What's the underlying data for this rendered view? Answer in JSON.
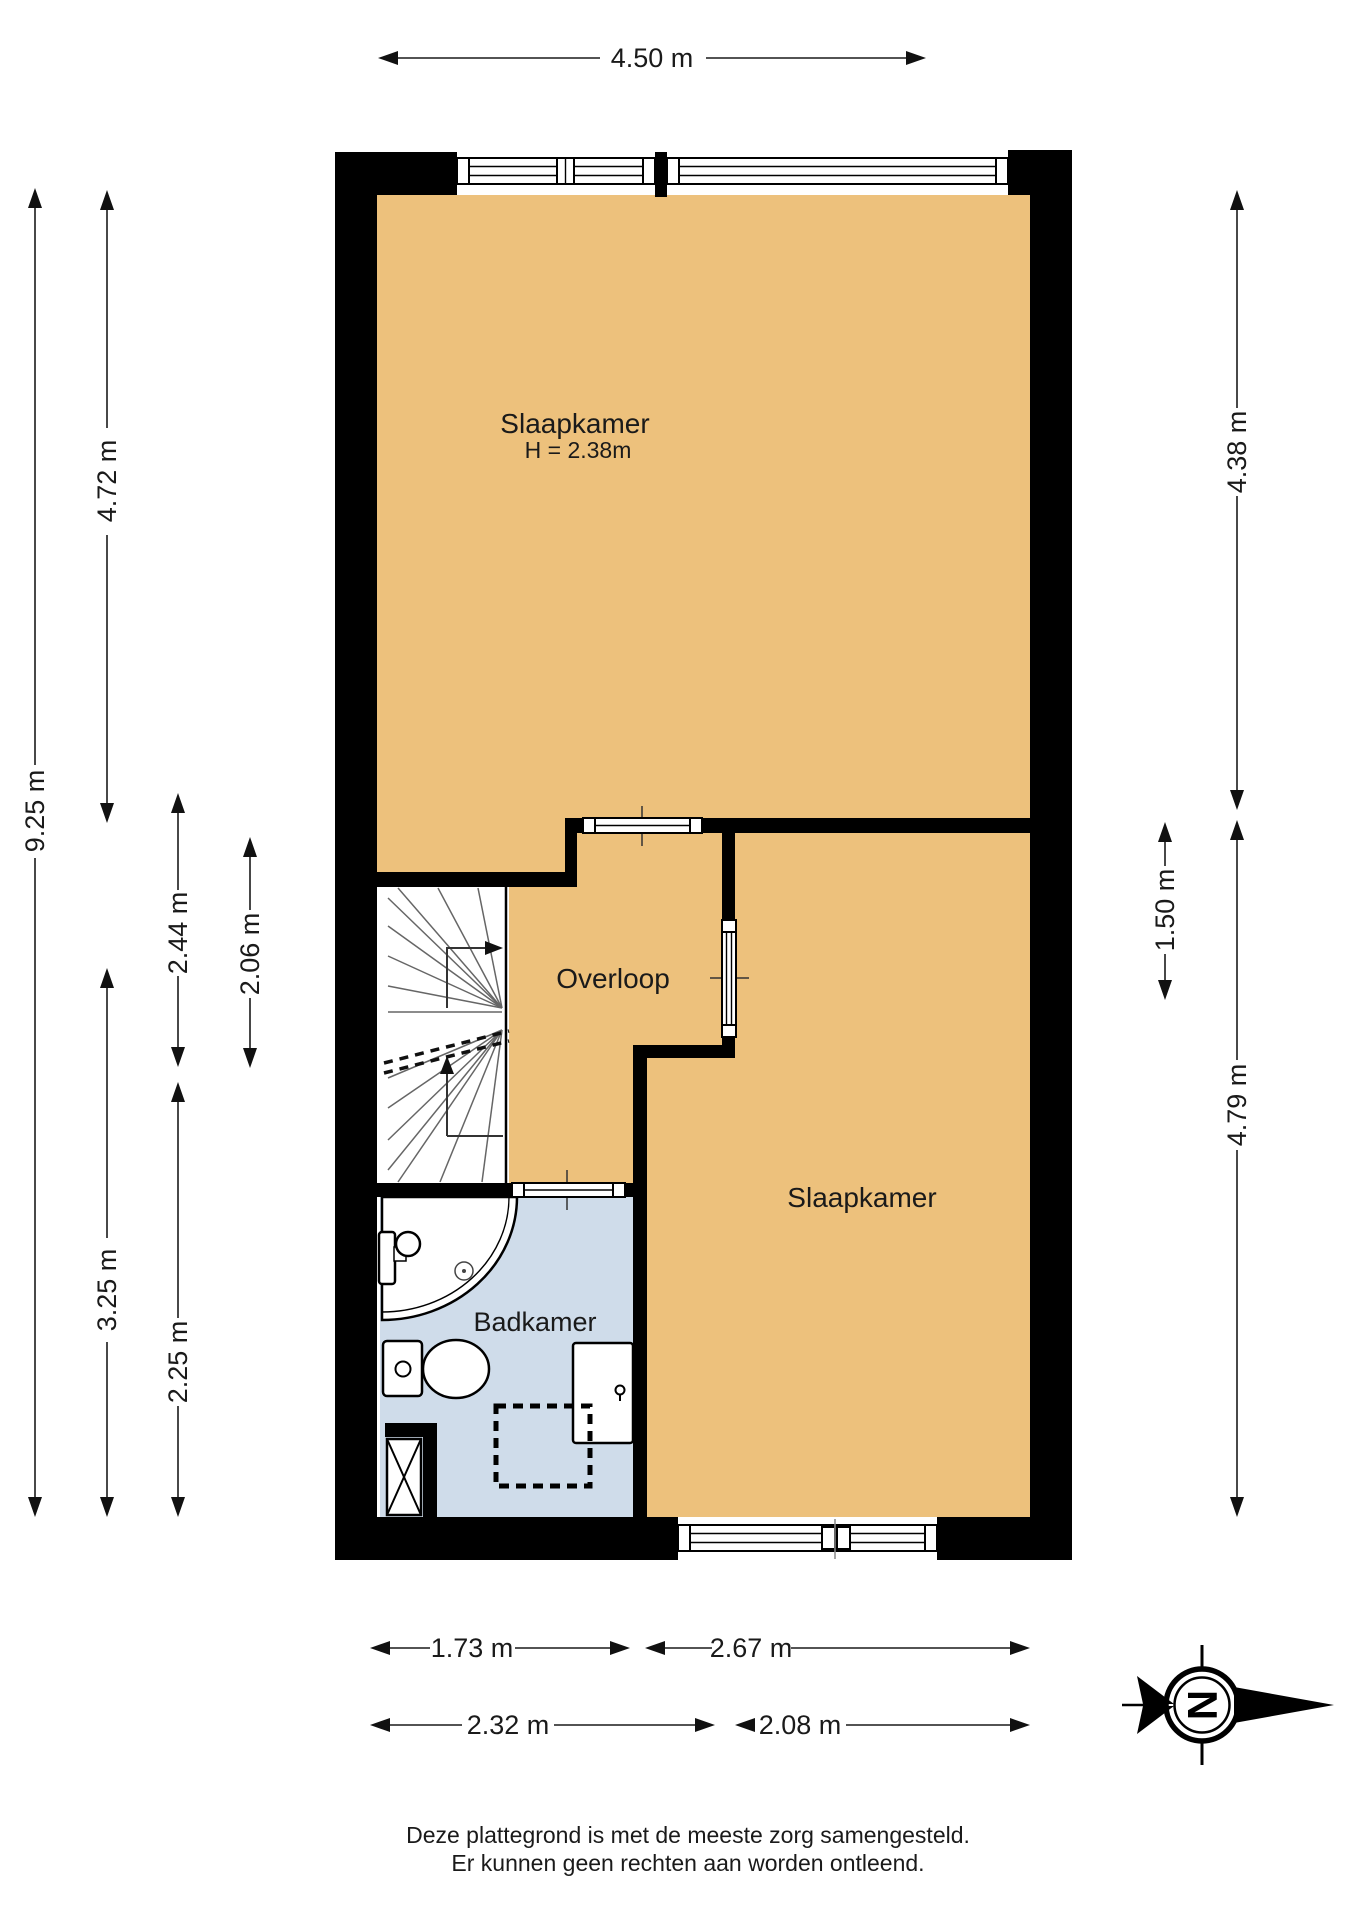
{
  "rooms": {
    "bedroom_top": {
      "label": "Slaapkamer",
      "height_note": "H = 2.38m"
    },
    "landing": {
      "label": "Overloop"
    },
    "bedroom_bottom": {
      "label": "Slaapkamer"
    },
    "bathroom": {
      "label": "Badkamer"
    }
  },
  "dimensions": {
    "top": [
      "4.50 m"
    ],
    "left": [
      "9.25 m",
      "4.72 m",
      "3.25 m",
      "2.44 m",
      "2.25 m",
      "2.06 m"
    ],
    "right": [
      "4.38 m",
      "1.50 m",
      "4.79 m"
    ],
    "bottom_row1": [
      "1.73 m",
      "2.67 m"
    ],
    "bottom_row2": [
      "2.32 m",
      "2.08 m"
    ]
  },
  "compass": {
    "north_label": "N"
  },
  "footer": {
    "line1": "Deze plattegrond is met de meeste zorg samengesteld.",
    "line2": "Er kunnen geen rechten aan worden ontleend."
  },
  "colors": {
    "room_fill": "#edc17c",
    "bathroom_fill": "#cfdcea",
    "wall": "#000000"
  }
}
